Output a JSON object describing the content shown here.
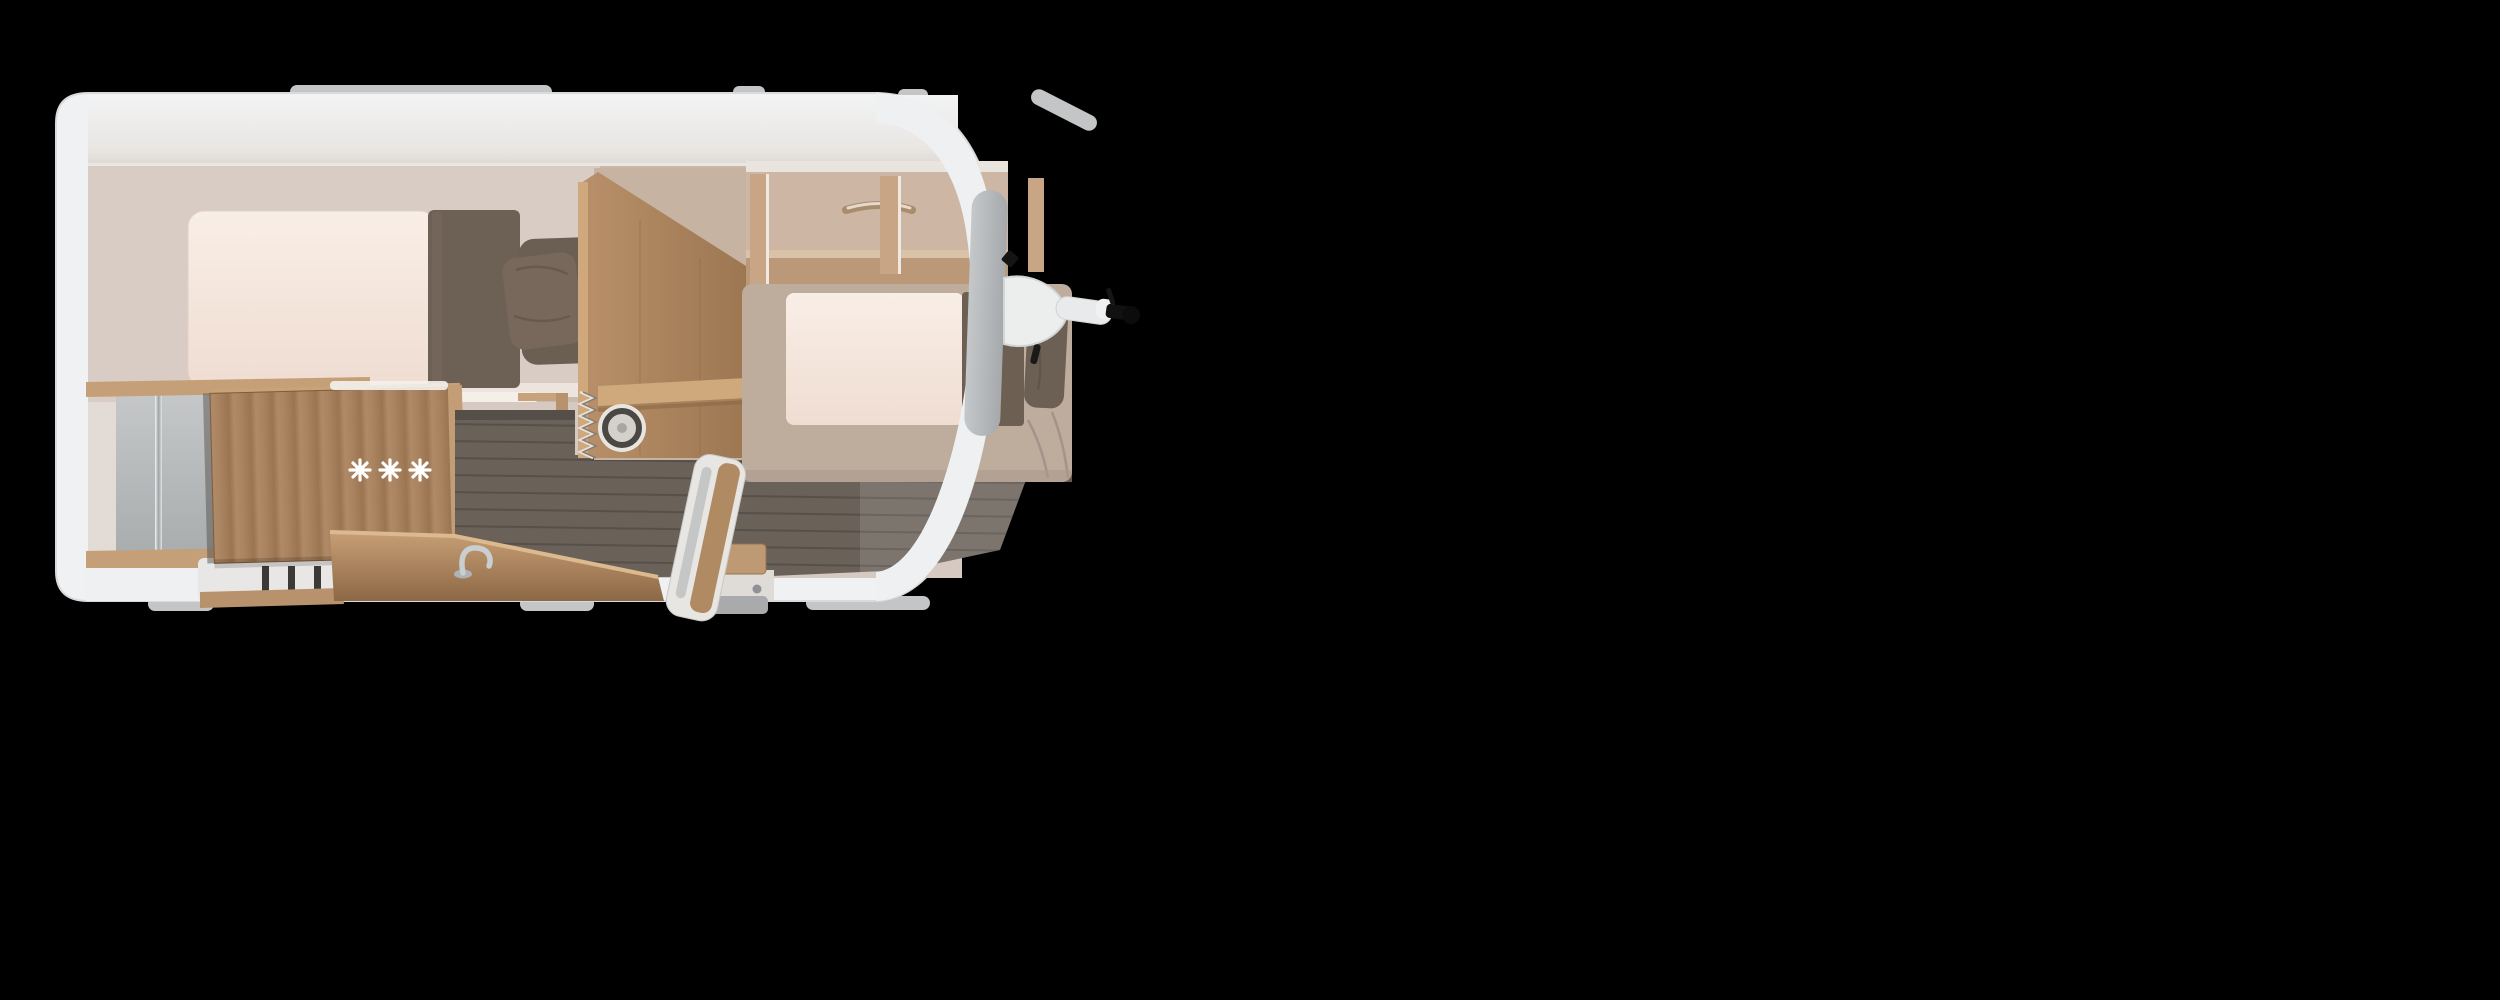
{
  "image": {
    "description": "Top-down 3D floor plan rendering of a single-axle caravan interior on a black background",
    "background_color": "#000000"
  },
  "caravan": {
    "shell_color": "#f0f1f2",
    "floor_color": "#6a6159",
    "wood_color": "#ab8561",
    "textile_color": "#6c6056",
    "mattress_color": "#f6e9e0",
    "accent_gray": "#b7babc",
    "hob_burners_symbol": "✳ ✳ ✳",
    "areas": [
      {
        "name": "rear-bedroom",
        "items": [
          "double-bed",
          "blanket",
          "pillows"
        ]
      },
      {
        "name": "bathroom",
        "items": [
          "shower-wall",
          "chrome-rail",
          "open-wooden-door",
          "step"
        ]
      },
      {
        "name": "wardrobe",
        "items": [
          "clothes-hangers",
          "shelf",
          "lower-cabinet"
        ]
      },
      {
        "name": "kitchen",
        "items": [
          "corner-counter",
          "faucet",
          "round-sink",
          "hob-burners"
        ]
      },
      {
        "name": "front-bedroom",
        "items": [
          "transverse-bed",
          "blanket",
          "pillow",
          "overhead-lockers"
        ]
      },
      {
        "name": "entrance",
        "items": [
          "open-entry-door",
          "entry-step"
        ]
      }
    ],
    "hitch": {
      "parts": [
        "drawbar-cover",
        "coupling-arm",
        "coupler-head"
      ]
    }
  }
}
